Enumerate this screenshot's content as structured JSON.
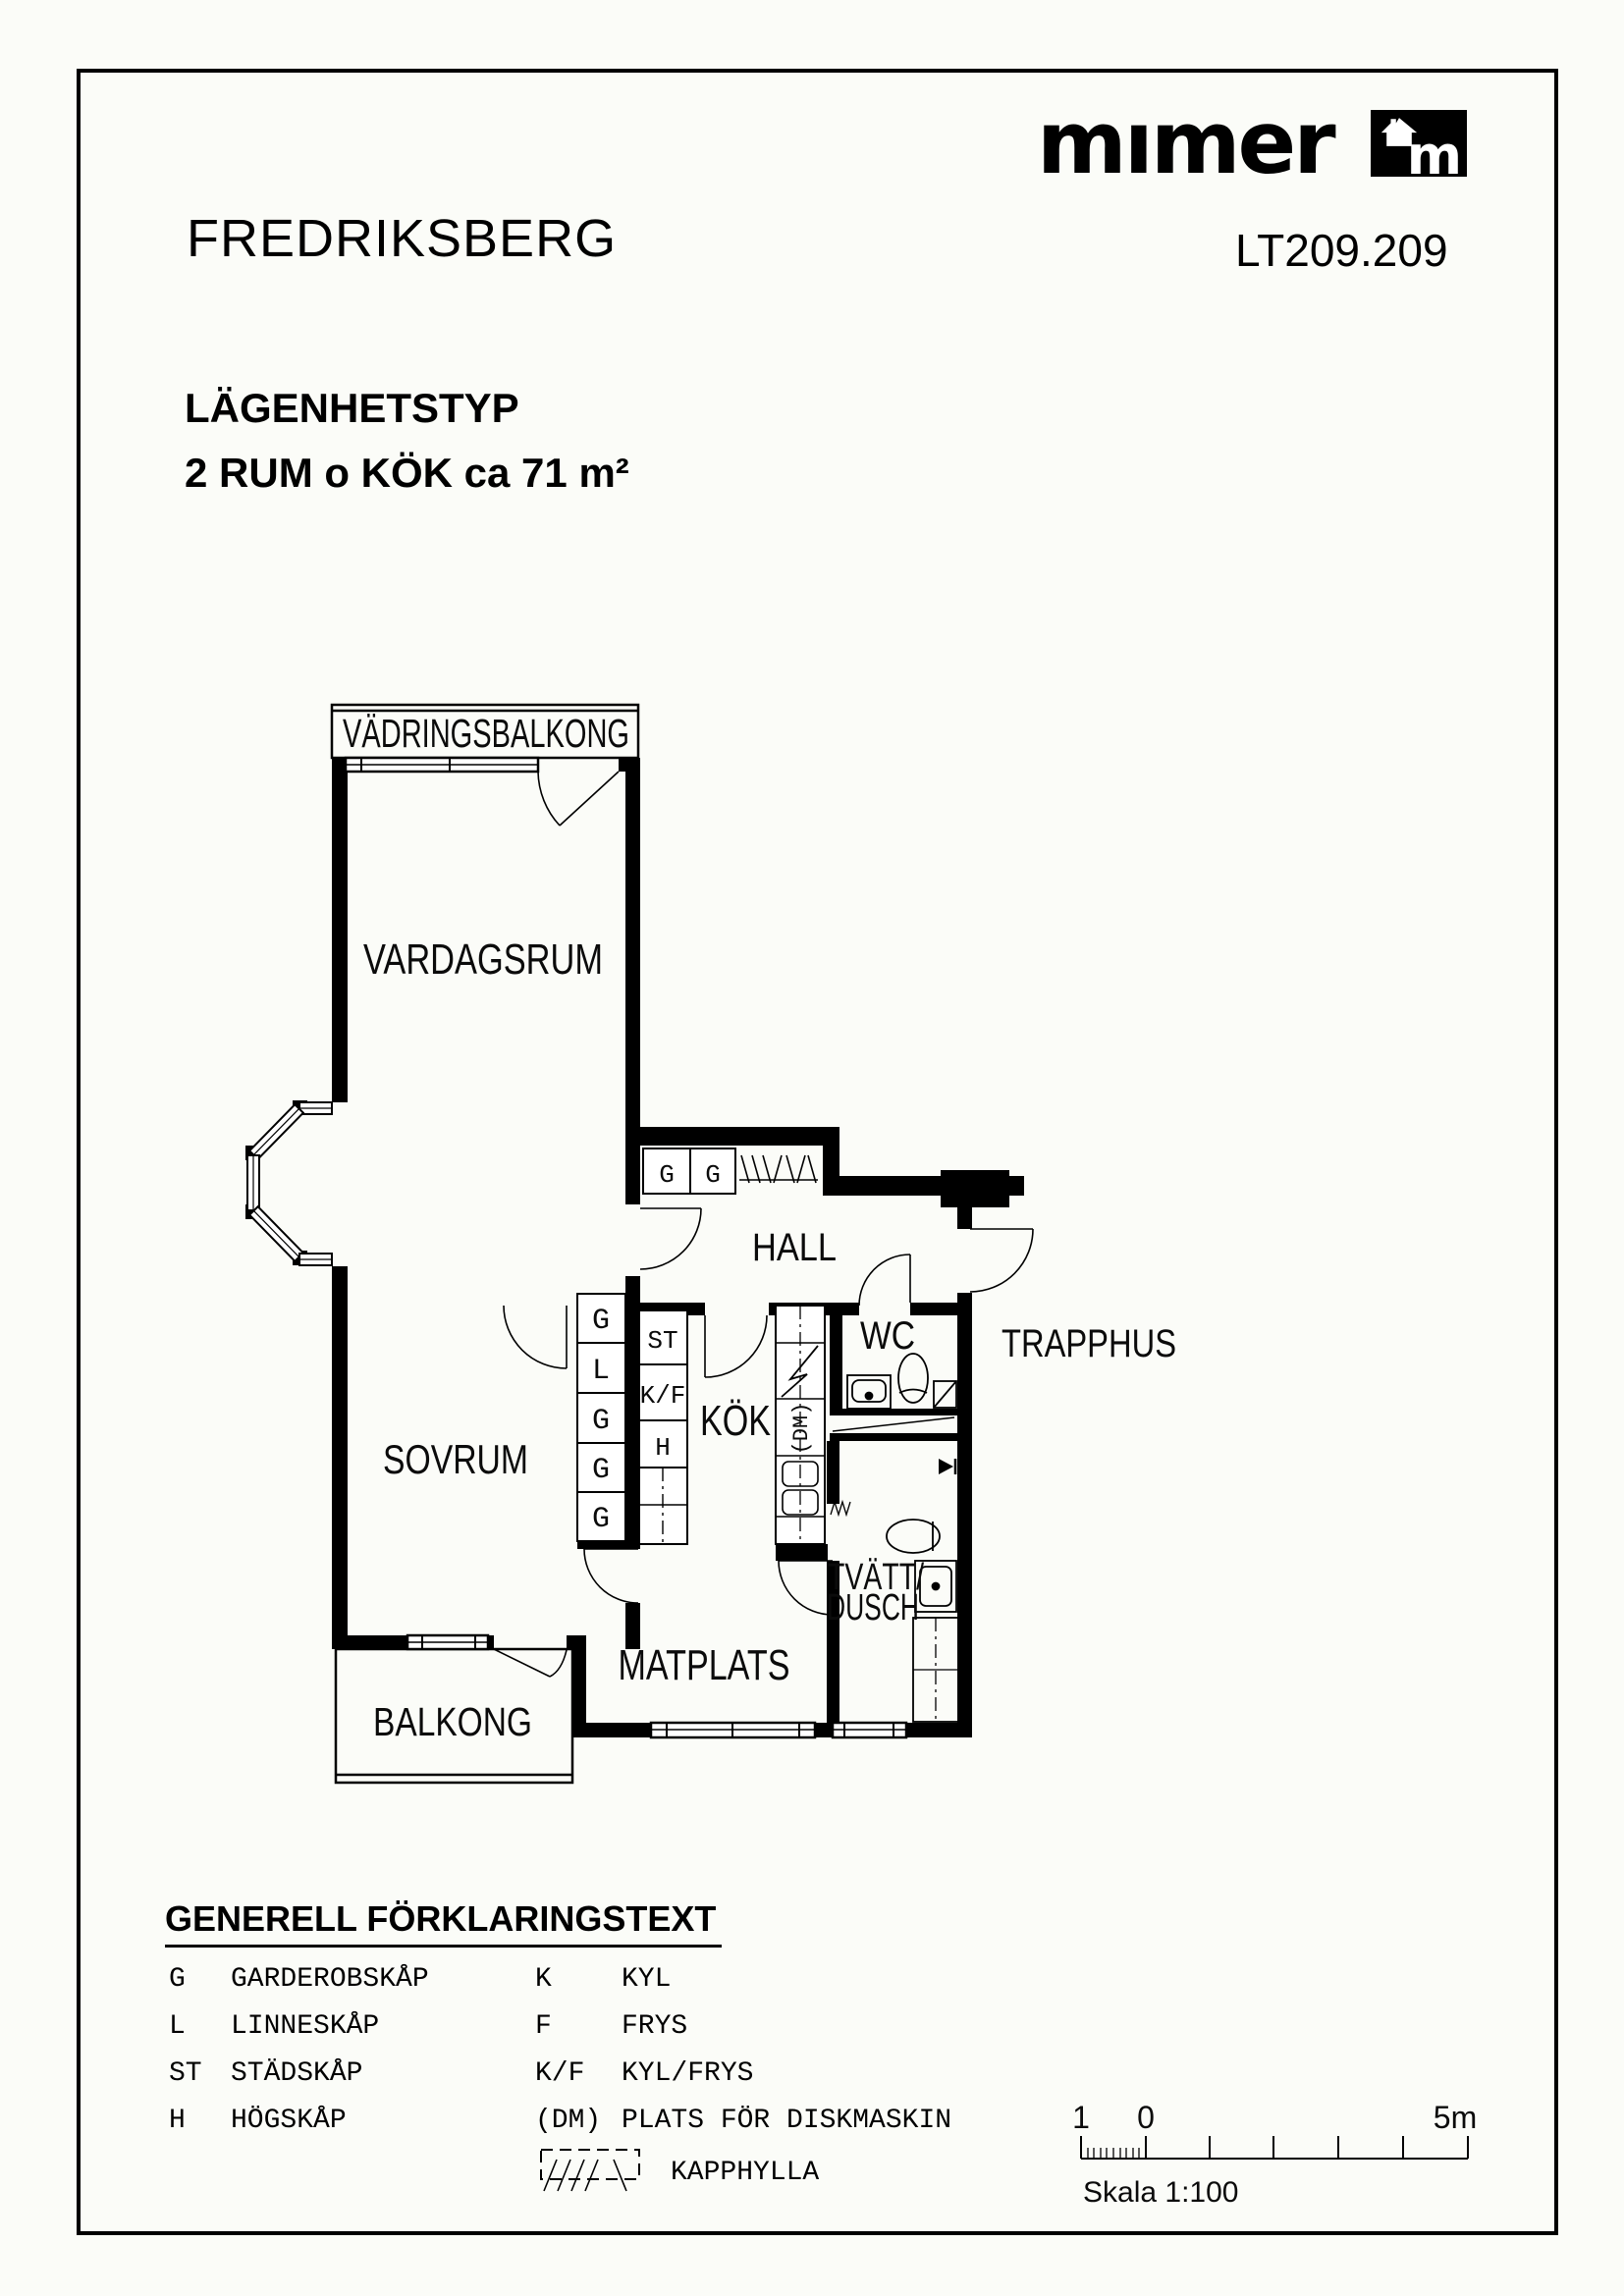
{
  "header": {
    "brand_word": "mımer",
    "logo_m": "m",
    "doc_no": "LT209.209",
    "project": "FREDRIKSBERG",
    "type_label": "LÄGENHETSTYP",
    "type_desc": "2 RUM o KÖK ca 71 m²"
  },
  "plan": {
    "rooms": {
      "vadringsbalkong": "VÄDRINGSBALKONG",
      "vardagsrum": "VARDAGSRUM",
      "hall": "HALL",
      "wc": "WC",
      "trapphus": "TRAPPHUS",
      "sovrum": "SOVRUM",
      "kok": "KÖK",
      "tvatt_line1": "TVÄTT/",
      "tvatt_line2": "DUSCH",
      "matplats": "MATPLATS",
      "balkong": "BALKONG"
    },
    "cabinets": {
      "g": "G",
      "l": "L",
      "st": "ST",
      "kf": "K/F",
      "h": "H",
      "dm": "(DM)"
    }
  },
  "legend": {
    "title": "GENERELL FÖRKLARINGSTEXT",
    "left": [
      {
        "abbr": "G",
        "label": "GARDEROBSKÅP"
      },
      {
        "abbr": "L",
        "label": "LINNESKÅP"
      },
      {
        "abbr": "ST",
        "label": "STÄDSKÅP"
      },
      {
        "abbr": "H",
        "label": "HÖGSKÅP"
      }
    ],
    "right": [
      {
        "abbr": "K",
        "label": "KYL"
      },
      {
        "abbr": "F",
        "label": "FRYS"
      },
      {
        "abbr": "K/F",
        "label": "KYL/FRYS"
      },
      {
        "abbr": "(DM)",
        "label": "PLATS FÖR DISKMASKIN"
      }
    ],
    "kapphylla": "KAPPHYLLA"
  },
  "scale_bar": {
    "one": "1",
    "zero": "0",
    "five": "5m",
    "caption": "Skala 1:100"
  }
}
